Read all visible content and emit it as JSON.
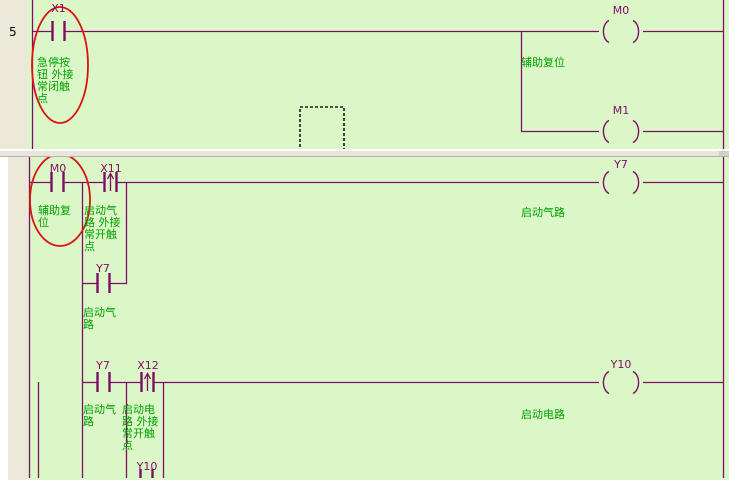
{
  "window": {
    "kind": "plc-ladder-editor",
    "view": "split-ladder-view"
  },
  "colors": {
    "background_green": "#dcf7c7",
    "margin_beige": "#ece9d9",
    "line_purple": "#7d0e66",
    "comment_green": "#00a000",
    "annotation_red": "#dd1111",
    "splitter_gray": "#e8e5de",
    "white": "#ffffff"
  },
  "pane1": {
    "step_number": "5",
    "contact_x1": {
      "name": "X1",
      "comment": "急停按\n钮 外接\n常闭触\n点"
    },
    "coil_m0": {
      "name": "M0",
      "comment": "辅助复位"
    },
    "coil_m1": {
      "name": "M1"
    }
  },
  "pane2": {
    "contact_m0": {
      "name": "M0",
      "comment": "辅助复\n位"
    },
    "contact_x11": {
      "name": "X11",
      "comment": "启动气\n路 外接\n常开触\n点"
    },
    "contact_y7_parallel": {
      "name": "Y7",
      "comment": "启动气\n路"
    },
    "coil_y7": {
      "name": "Y7",
      "comment": "启动气路"
    },
    "contact_y7": {
      "name": "Y7",
      "comment": "启动气\n路"
    },
    "contact_x12": {
      "name": "X12",
      "comment": "启动电\n路 外接\n常开触\n点"
    },
    "coil_y10": {
      "name": "Y10",
      "comment": "启动电路"
    },
    "contact_y10": {
      "name": "Y10"
    }
  }
}
